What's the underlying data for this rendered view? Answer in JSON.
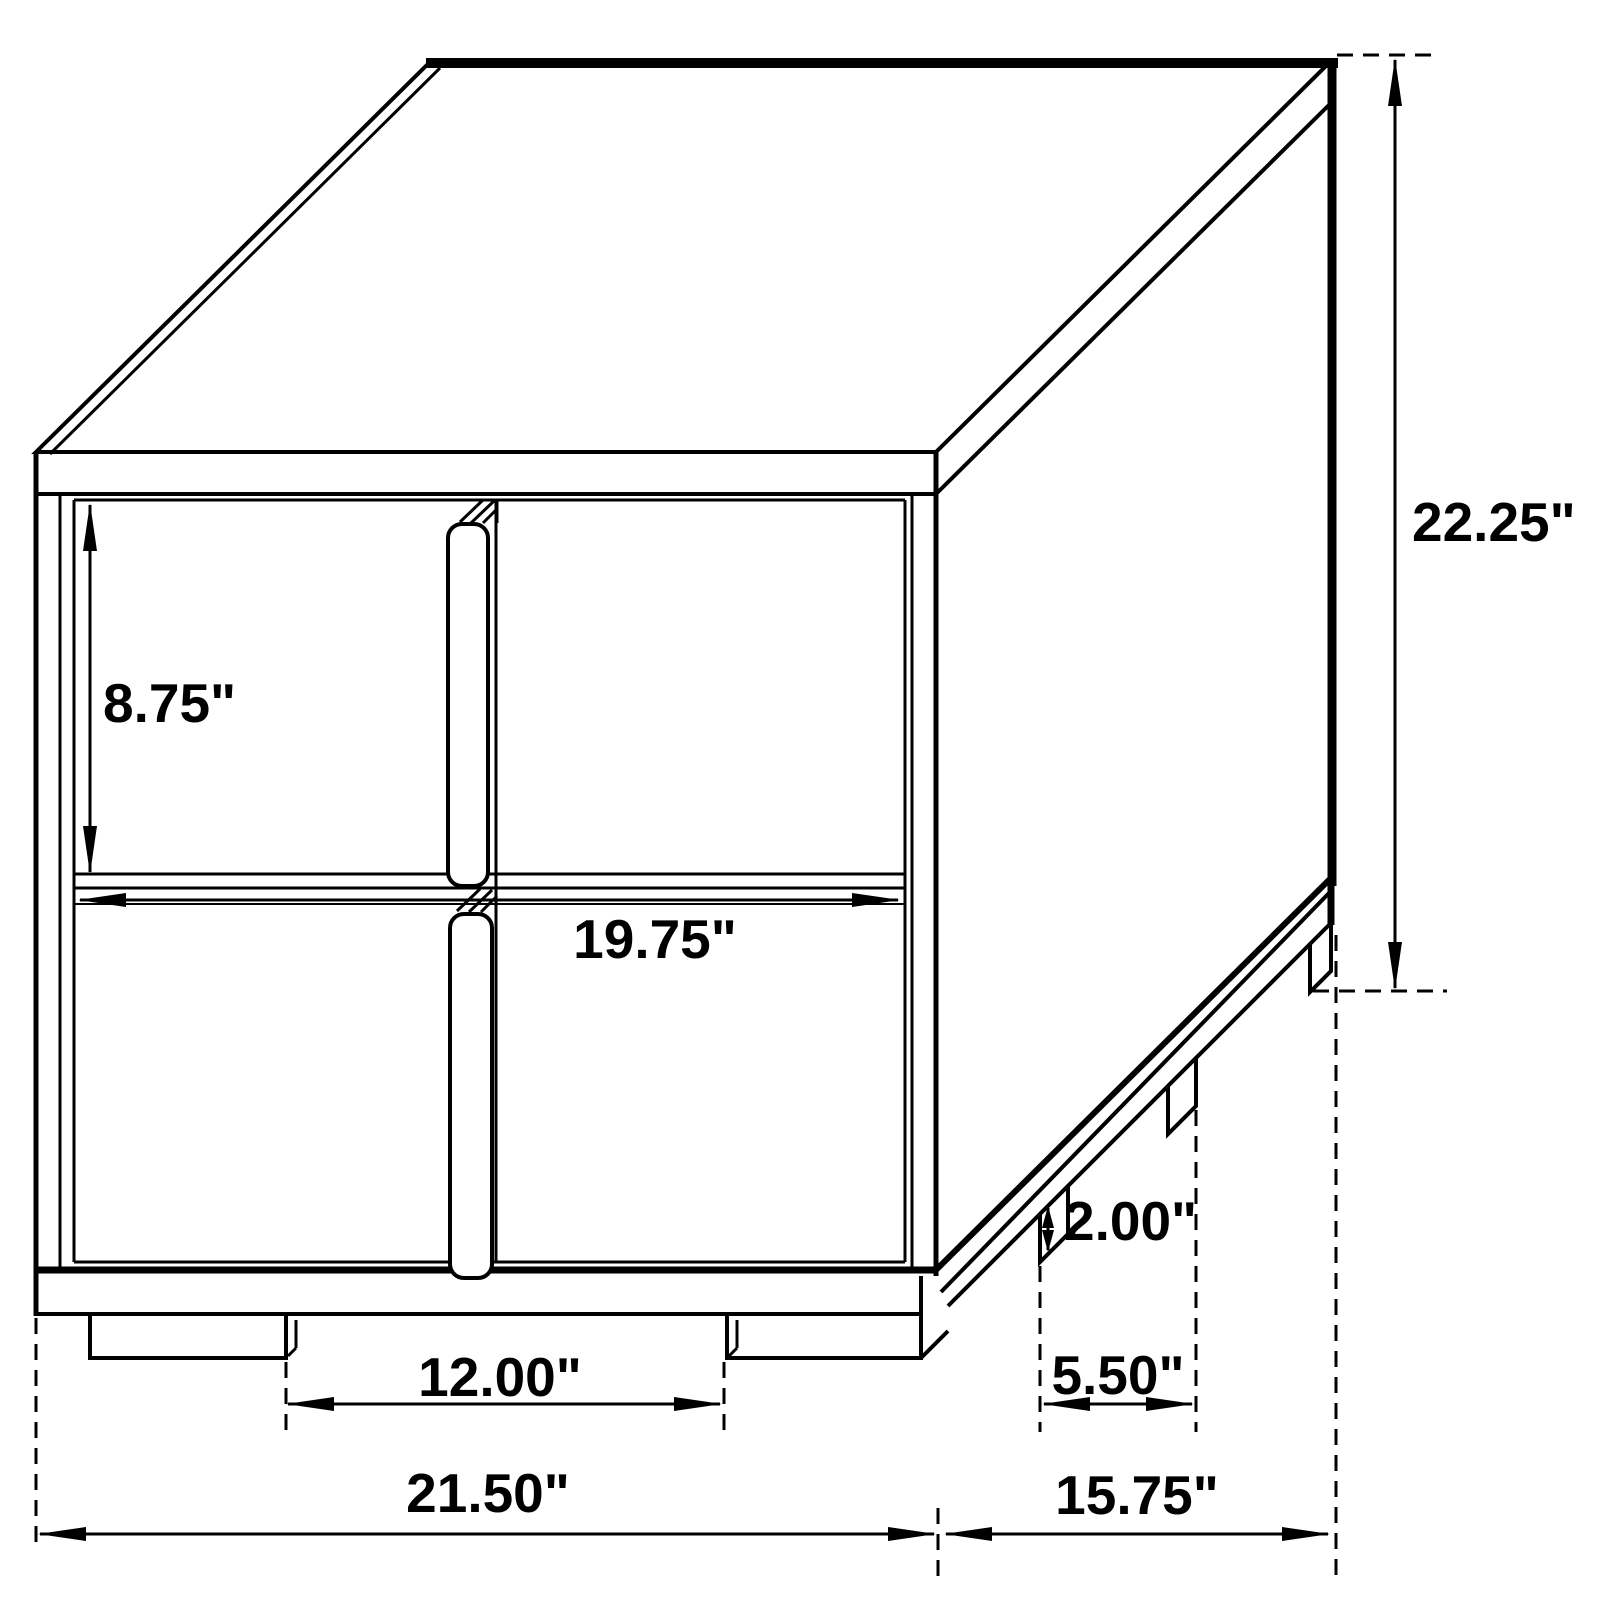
{
  "diagram": {
    "kind": "furniture-dimension-drawing",
    "subject": "two-drawer nightstand perspective view",
    "colors": {
      "background": "#ffffff",
      "line": "#000000",
      "text": "#000000"
    },
    "labels": {
      "drawer_height": "8.75\"",
      "drawer_front_width": "19.75\"",
      "overall_height": "22.25\"",
      "leg_height": "2.00\"",
      "front_leg_gap": "12.00\"",
      "side_leg_gap": "5.50\"",
      "overall_width": "21.50\"",
      "overall_depth": "15.75\""
    }
  }
}
